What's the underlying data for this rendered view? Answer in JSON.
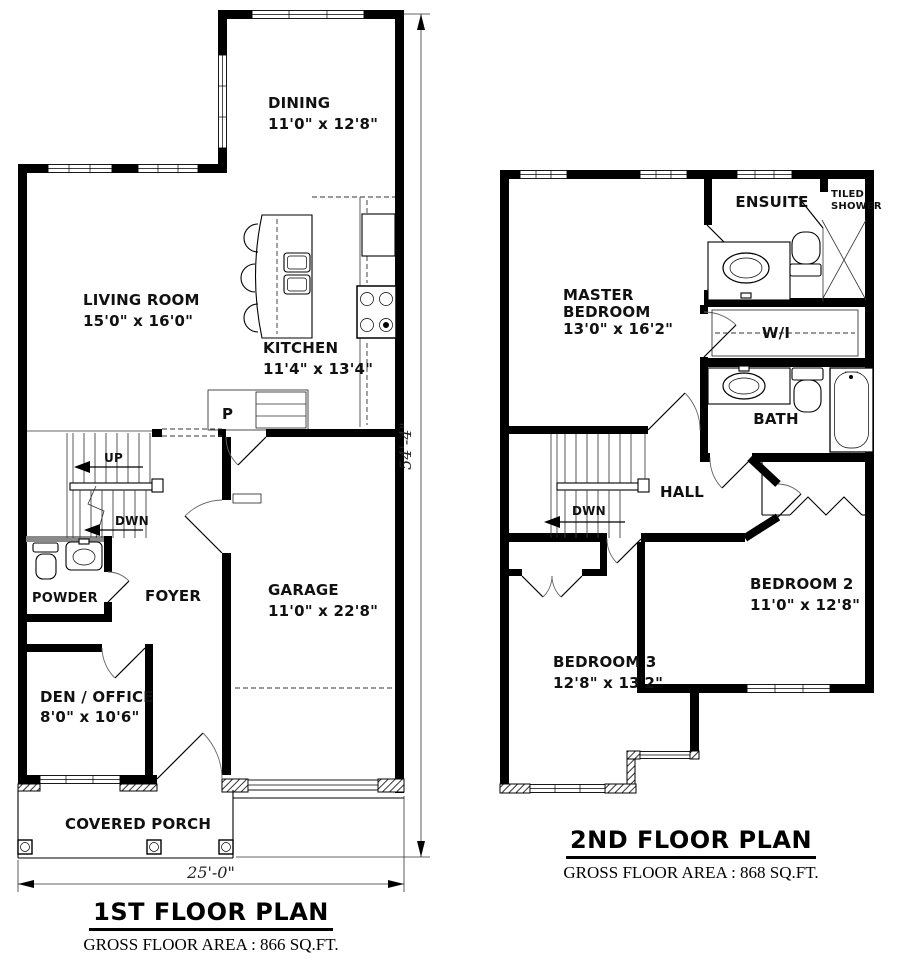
{
  "floor1": {
    "title": "1ST FLOOR PLAN",
    "area": "GROSS FLOOR AREA : 866 SQ.FT.",
    "dim_width": "25'-0\"",
    "dim_height": "54'-4\"",
    "rooms": {
      "dining": {
        "name": "DINING",
        "dims": "11'0\" x 12'8\""
      },
      "living": {
        "name": "LIVING ROOM",
        "dims": "15'0\" x 16'0\""
      },
      "kitchen": {
        "name": "KITCHEN",
        "dims": "11'4\" x 13'4\""
      },
      "pantry": {
        "name": "P"
      },
      "powder": {
        "name": "POWDER"
      },
      "foyer": {
        "name": "FOYER"
      },
      "garage": {
        "name": "GARAGE",
        "dims": "11'0\" x 22'8\""
      },
      "den": {
        "name": "DEN / OFFICE",
        "dims": "8'0\" x 10'6\""
      },
      "porch": {
        "name": "COVERED PORCH"
      }
    },
    "stairs": {
      "up": "UP",
      "down": "DWN"
    }
  },
  "floor2": {
    "title": "2ND FLOOR PLAN",
    "area": "GROSS FLOOR AREA : 868 SQ.FT.",
    "rooms": {
      "master": {
        "line1": "MASTER",
        "line2": "BEDROOM",
        "dims": "13'0\" x 16'2\""
      },
      "ensuite": {
        "name": "ENSUITE"
      },
      "shower": {
        "line1": "TILED",
        "line2": "SHOWER"
      },
      "walkin": {
        "name": "W/I"
      },
      "bath": {
        "name": "BATH"
      },
      "hall": {
        "name": "HALL"
      },
      "bedroom2": {
        "name": "BEDROOM 2",
        "dims": "11'0\" x 12'8\""
      },
      "bedroom3": {
        "name": "BEDROOM 3",
        "dims": "12'8\" x 13'2\""
      }
    },
    "stairs": {
      "down": "DWN"
    }
  }
}
